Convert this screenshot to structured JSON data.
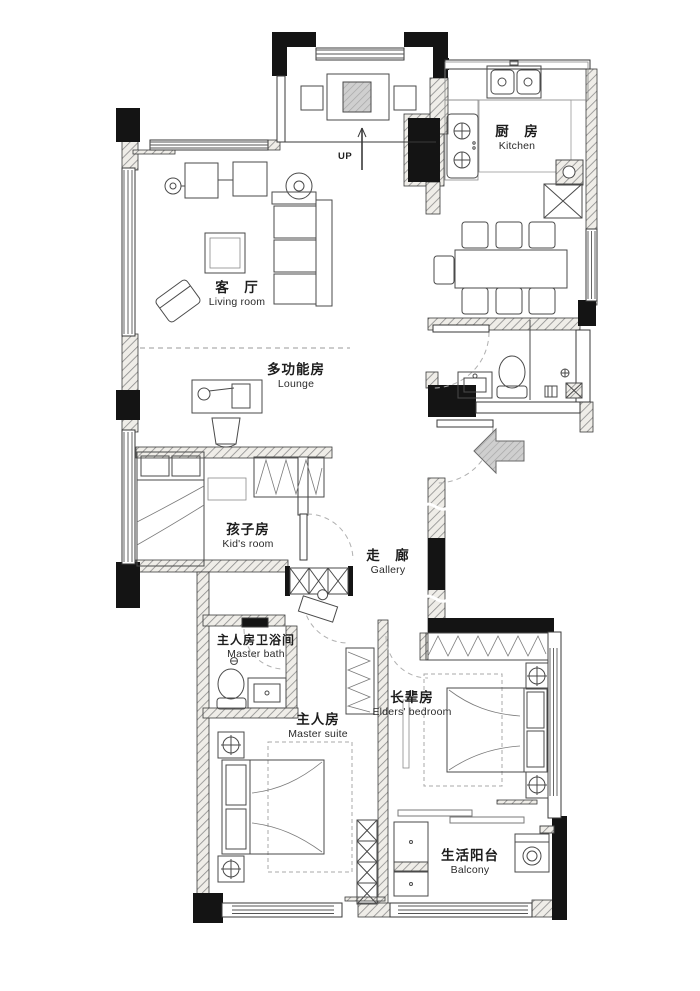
{
  "plan": {
    "title": "apartment-floor-plan",
    "rooms": [
      {
        "key": "living",
        "zh": "客　厅",
        "en": "Living room"
      },
      {
        "key": "lounge",
        "zh": "多功能房",
        "en": "Lounge"
      },
      {
        "key": "kitchen",
        "zh": "厨　房",
        "en": "Kitchen"
      },
      {
        "key": "kids",
        "zh": "孩子房",
        "en": "Kid's room"
      },
      {
        "key": "gallery",
        "zh": "走　廊",
        "en": "Gallery"
      },
      {
        "key": "masterbath",
        "zh": "主人房卫浴间",
        "en": "Master bath"
      },
      {
        "key": "master",
        "zh": "主人房",
        "en": "Master suite"
      },
      {
        "key": "elders",
        "zh": "长辈房",
        "en": "Elders' bedroom"
      },
      {
        "key": "balcony",
        "zh": "生活阳台",
        "en": "Balcony"
      }
    ],
    "annotations": {
      "up": "UP"
    },
    "colors": {
      "ink": "#2a2a2a",
      "wall_hatch": "#8a8a8a",
      "entry_arrow": "#c4c4c4"
    }
  }
}
